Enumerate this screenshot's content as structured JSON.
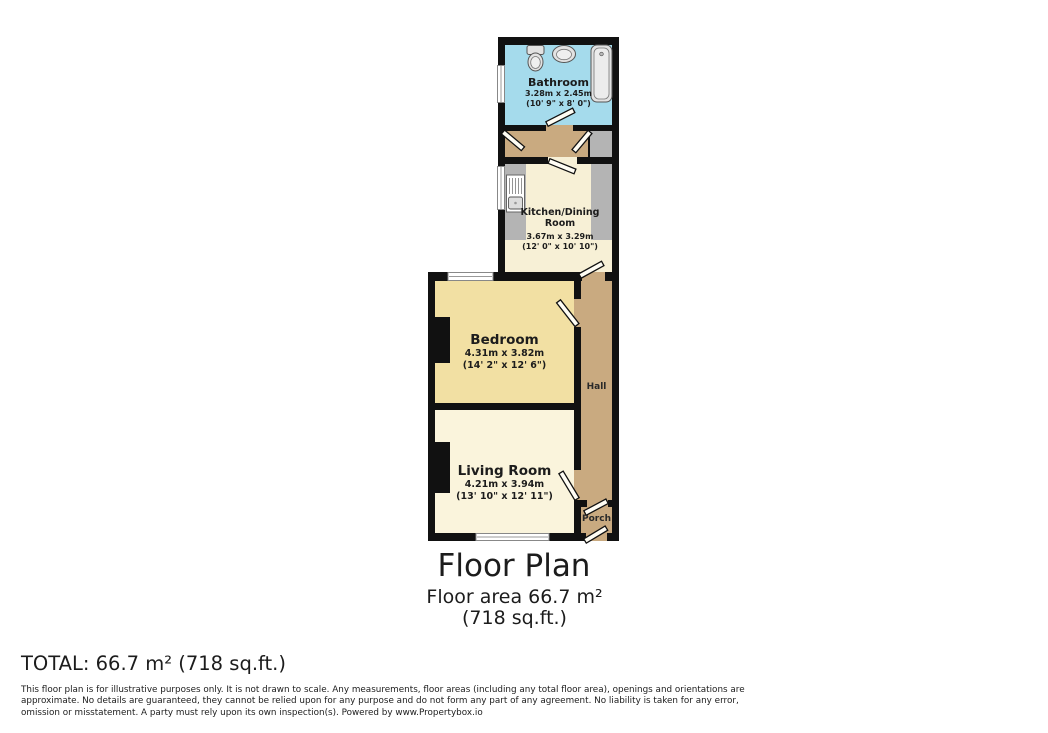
{
  "page": {
    "title": "Floor Plan",
    "subtitle": "Floor area 66.7 m² (718 sq.ft.)",
    "total": "TOTAL: 66.7 m² (718 sq.ft.)",
    "disclaimer": "This floor plan is for illustrative purposes only. It is not drawn to scale. Any measurements, floor areas (including any total floor area), openings and orientations are approximate. No details are guaranteed, they cannot be relied upon for any purpose and do not form any part of any agreement. No liability is taken for any error, omission or misstatement. A party must rely upon its own inspection(s). Powered by www.Propertybox.io"
  },
  "rooms": {
    "bathroom": {
      "name": "Bathroom",
      "metric": "3.28m x 2.45m",
      "imperial": "(10' 9\" x 8' 0\")"
    },
    "kitchen": {
      "name": "Kitchen/Dining Room",
      "metric": "3.67m x 3.29m",
      "imperial": "(12' 0\" x 10' 10\")"
    },
    "bedroom": {
      "name": "Bedroom",
      "metric": "4.31m x 3.82m",
      "imperial": "(14' 2\" x 12' 6\")"
    },
    "living_room": {
      "name": "Living Room",
      "metric": "4.21m x 3.94m",
      "imperial": "(13' 10\" x 12' 11\")"
    },
    "hall": {
      "name": "Hall"
    },
    "porch": {
      "name": "Porch"
    }
  },
  "colors": {
    "wall": "#111111",
    "bathroom_fill": "#a5dbec",
    "kitchen_fill": "#f7f0d6",
    "bedroom_fill": "#f2e0a3",
    "living_room_fill": "#faf4dc",
    "hall_fill": "#c9aa80",
    "counter_fill": "#b4b4b4",
    "window_fill": "#ffffff"
  }
}
